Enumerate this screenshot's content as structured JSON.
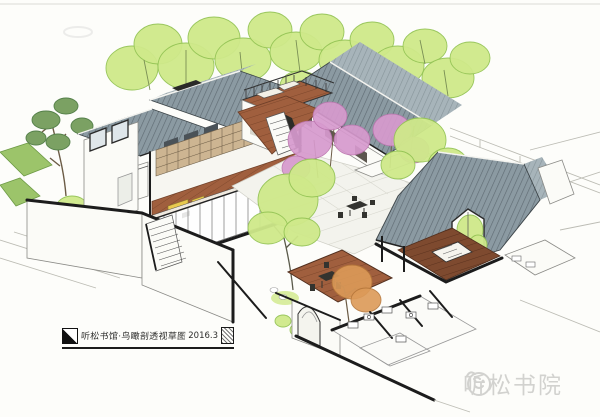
{
  "annotation": {
    "title": "听松书馆·鸟瞰剖透视草图",
    "date": "2016.3"
  },
  "watermark": {
    "brand": "听松书院"
  },
  "icons": {
    "title_logo": "diagonal-split-square",
    "title_seal": "carved-seal-stamp",
    "brand_logo": "tingsong-face-logo"
  },
  "colors": {
    "paper": "#fdfdfa",
    "ink": "#1c1c1c",
    "roof": "#8b9aa2",
    "roof-light": "#a7b4ba",
    "leaf": "#cfe98a",
    "leaf-stroke": "#94c455",
    "pine": "#7ba163",
    "blossom": "#d79ace",
    "blossom-stroke": "#bb74ae",
    "wood": "#a05f3e",
    "wood-dark": "#7e4a2f",
    "autumn": "#dc9a58",
    "paving": "#f3f3ed",
    "paving-line": "#d9d9d0",
    "wall-line": "#8a8a86",
    "furniture": "#33332f",
    "sofa": "#e9c94f",
    "watermark": "#d2d2cf",
    "pencil": "#bcbcb4"
  }
}
